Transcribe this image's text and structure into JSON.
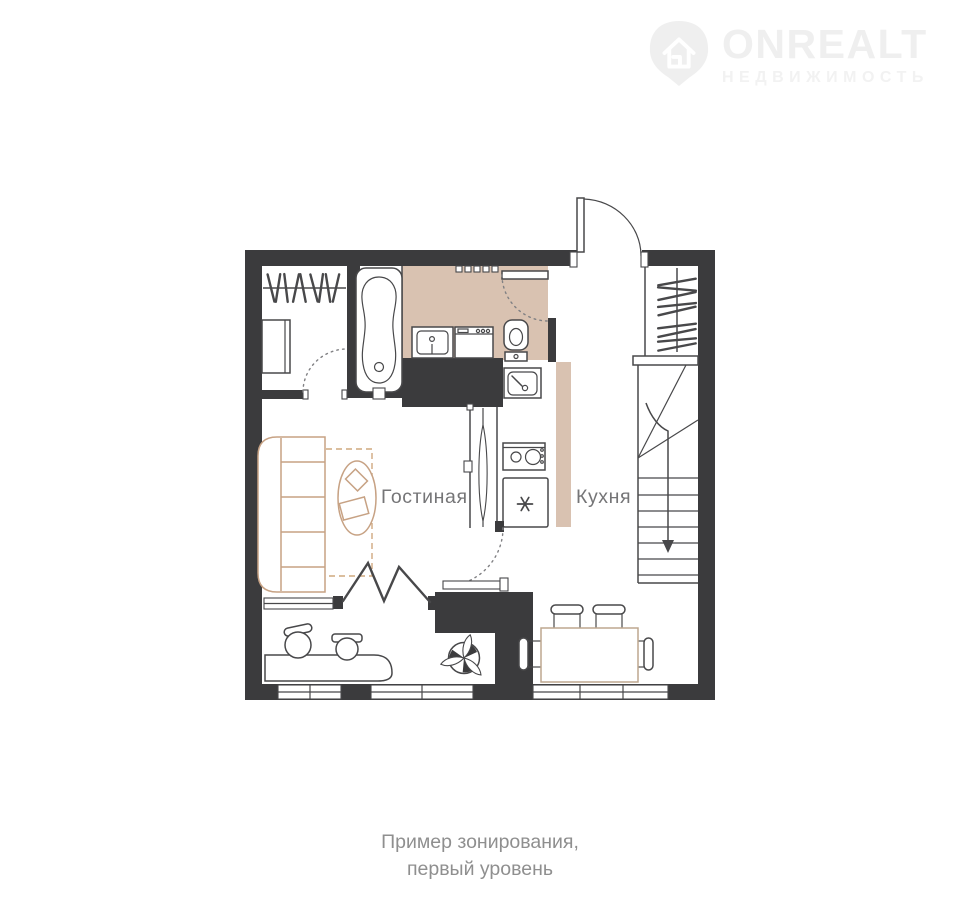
{
  "logo": {
    "icon": "map-pin-house-icon",
    "brand": "ONREALT",
    "tagline": "НЕДВИЖИМОСТЬ"
  },
  "plan": {
    "labels": {
      "living_room": "Гостиная",
      "kitchen": "Кухня"
    }
  },
  "caption": {
    "line1": "Пример зонирования,",
    "line2": "первый уровень"
  },
  "colors": {
    "wall": "#3b3b3d",
    "outline": "#48484a",
    "floor-accent": "#d9c2b1",
    "furniture-accent": "#c7a284",
    "zone-line": "#cfa87f",
    "table-accent": "#bda78f",
    "label-text": "#757577",
    "caption-text": "#8f8f8f",
    "logo-gray": "#efefef",
    "background": "#ffffff"
  }
}
